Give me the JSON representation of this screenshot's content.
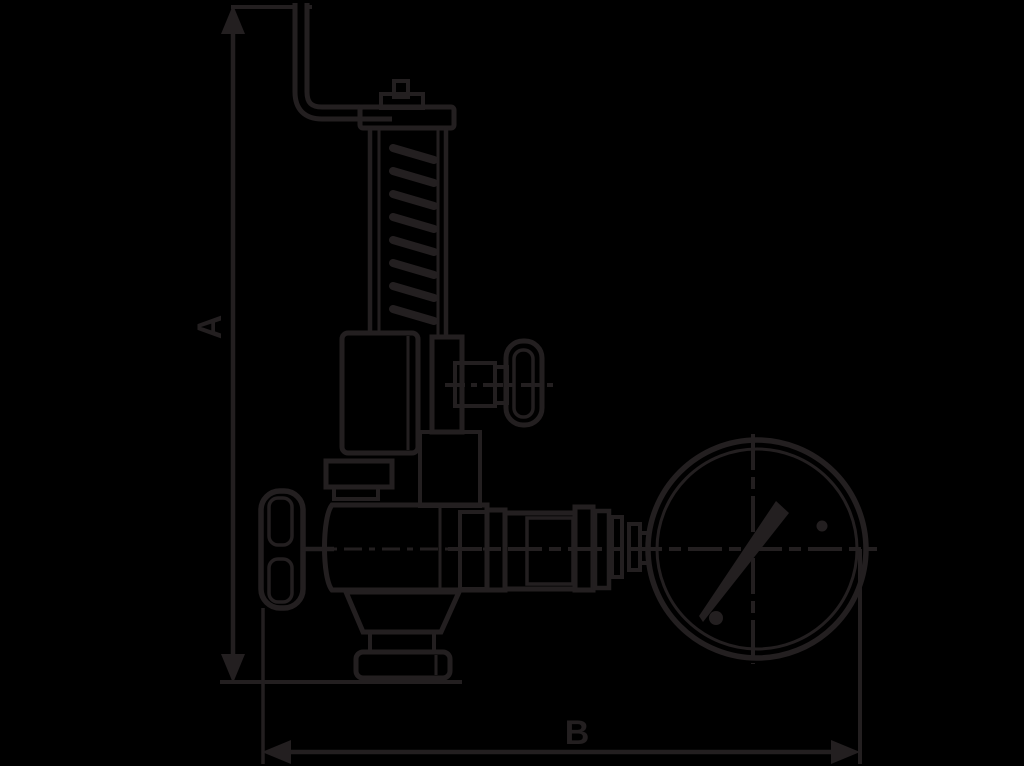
{
  "figure": {
    "type": "technical-line-drawing",
    "description": "Outline drawing of a spring-loaded safety relief valve with test lever, side test valve, inlet handwheel, bottom outlet flange and connected pressure gauge, with overall dimensions marked",
    "dimension_labels": {
      "a": "A",
      "b": "B"
    },
    "components": [
      "dimension-line-a",
      "dimension-line-b",
      "test-lever",
      "spring-cap",
      "spring-housing",
      "spring-coils",
      "bonnet",
      "side-test-valve",
      "test-valve-handwheel",
      "inlet-handwheel",
      "valve-body",
      "outlet-flange",
      "gauge-piping",
      "pressure-gauge",
      "gauge-needle"
    ]
  },
  "colors": {
    "background": "#000000",
    "line": "#231F20"
  }
}
